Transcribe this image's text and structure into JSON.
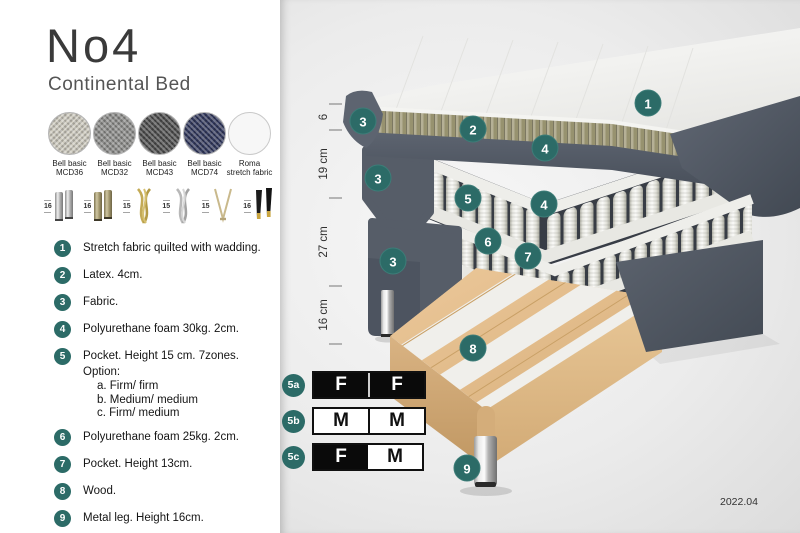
{
  "title": "No4",
  "subtitle": "Continental Bed",
  "fabrics": [
    {
      "line1": "Bell basic",
      "line2": "MCD36",
      "color": "#cfccc0"
    },
    {
      "line1": "Bell basic",
      "line2": "MCD32",
      "color": "#8e8e8c"
    },
    {
      "line1": "Bell basic",
      "line2": "MCD43",
      "color": "#4e4e4e"
    },
    {
      "line1": "Bell basic",
      "line2": "MCD74",
      "color": "#333a5e"
    },
    {
      "line1": "Roma",
      "line2": "stretch fabric",
      "color": "#f7f7f7"
    }
  ],
  "legs": [
    {
      "height": "16",
      "type": "cylinder-silver"
    },
    {
      "height": "16",
      "type": "cylinder-bronze"
    },
    {
      "height": "15",
      "type": "crossed-gold"
    },
    {
      "height": "15",
      "type": "crossed-silver"
    },
    {
      "height": "15",
      "type": "hairpin-gold"
    },
    {
      "height": "16",
      "type": "tapered-black-gold"
    }
  ],
  "features": [
    {
      "num": "1",
      "text": "Stretch fabric quilted with wadding."
    },
    {
      "num": "2",
      "text": "Latex. 4cm."
    },
    {
      "num": "3",
      "text": "Fabric."
    },
    {
      "num": "4",
      "text": "Polyurethane foam 30kg. 2cm."
    },
    {
      "num": "5",
      "text": "Pocket. Height 15 cm. 7zones. Option:",
      "options": [
        "a. Firm/ firm",
        "b. Medium/ medium",
        "c. Firm/ medium"
      ]
    },
    {
      "num": "6",
      "text": "Polyurethane foam 25kg. 2cm."
    },
    {
      "num": "7",
      "text": "Pocket. Height 13cm."
    },
    {
      "num": "8",
      "text": "Wood."
    },
    {
      "num": "9",
      "text": "Metal leg. Height 16cm."
    }
  ],
  "diagram": {
    "measurements": [
      {
        "label": "6"
      },
      {
        "label": "19 cm"
      },
      {
        "label": "27 cm"
      },
      {
        "label": "16 cm"
      }
    ],
    "badges": [
      {
        "label": "1"
      },
      {
        "label": "2"
      },
      {
        "label": "3"
      },
      {
        "label": "3"
      },
      {
        "label": "3"
      },
      {
        "label": "4"
      },
      {
        "label": "4"
      },
      {
        "label": "5"
      },
      {
        "label": "6"
      },
      {
        "label": "7"
      },
      {
        "label": "8"
      },
      {
        "label": "9"
      }
    ],
    "version": "2022.04"
  },
  "firmness_table": {
    "rows": [
      {
        "id": "5a",
        "cell1": "F",
        "cell2": "F"
      },
      {
        "id": "5b",
        "cell1": "M",
        "cell2": "M"
      },
      {
        "id": "5c",
        "cell1": "F",
        "cell2": "M"
      }
    ]
  },
  "colors": {
    "badge_teal": "#2c6b67",
    "upholstery_gray": "#565d68",
    "latex_olive": "#b0ab8e",
    "wood_tan": "#dfb988",
    "spring_white": "#f4f4f0"
  }
}
